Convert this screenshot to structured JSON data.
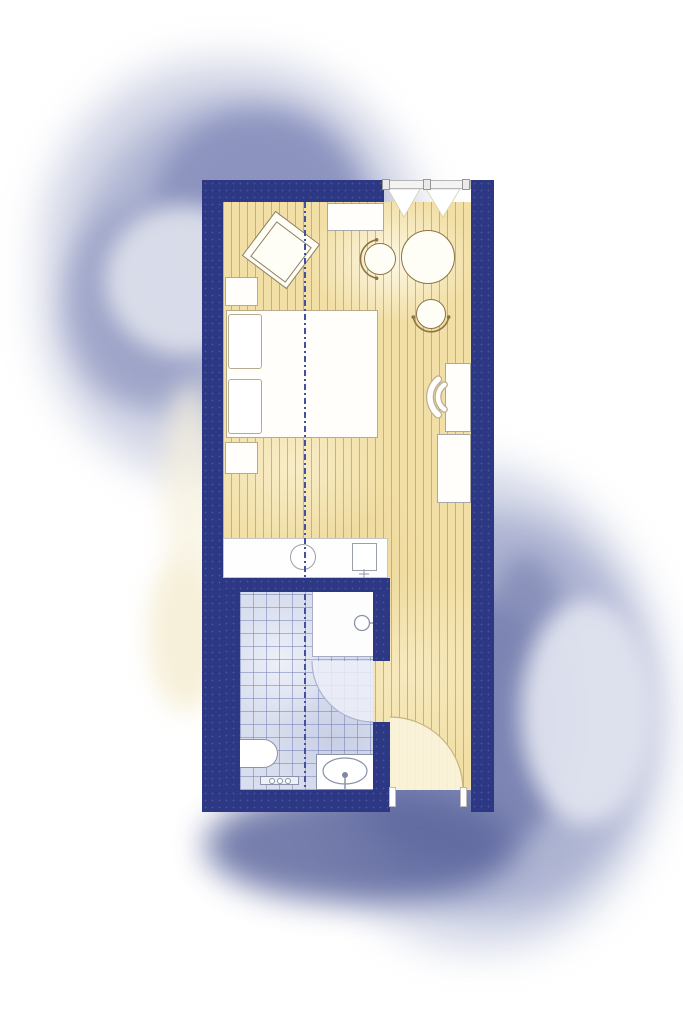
{
  "scene": {
    "type": "architectural floor plan",
    "description": "Hotel guest-room floor plan on a watercolor wash background: bedroom-living area with wood flooring, tiled bathroom, and entry corridor",
    "orientation": "portrait"
  },
  "rooms": {
    "bedroom": "Bedroom / living area with wood plank floor",
    "bathroom": "Bathroom with tiled floor",
    "corridor": "Entry corridor with wood plank floor"
  },
  "architecture": {
    "walls": "thick navy walls",
    "window": "glazed window band on top wall with three mullions and curtain zigzag",
    "entry_door": "entry door swing at bottom of corridor",
    "bathroom_door": "door swing from corridor into bathroom",
    "centerline": "blue dash-dot section centerline running vertically through plan"
  },
  "furniture": {
    "armchair": "tilted lounge armchair",
    "console": "console shelf at window wall",
    "round_table": "round dining table",
    "chair_a": "dining chair left of table",
    "chair_b": "dining chair below table",
    "bed": "double bed with two pillows",
    "nightstand_1": "nightstand above bed",
    "nightstand_2": "nightstand below bed",
    "desk": "desk on right wall",
    "desk_chair": "desk chair arcs",
    "cabinet": "cabinet / minibar unit on right wall",
    "counter": "vanity counter with round basin and amenity box"
  },
  "fixtures": {
    "shower": "walk-in shower with shower-head symbol",
    "toilet": "wall-hung toilet",
    "sink": "washbasin with oval bowl and tap",
    "towel_rail": "towel rail with hooks"
  },
  "colors": {
    "wall_navy": "#2d3884",
    "wood_floor": "#f2dfa5",
    "wood_stripe": "#a47e3c",
    "tile_floor": "#d9deee",
    "tile_grid": "#6c7ab0",
    "centerline_blue": "#42519f",
    "fixture_outline": "#8a93a8",
    "furniture_outline": "#8c7544",
    "watercolor_light": "#cdd2e4",
    "watercolor_mid": "#a6adce",
    "watercolor_dark": "#7982b1",
    "paper": "#ffffff"
  }
}
